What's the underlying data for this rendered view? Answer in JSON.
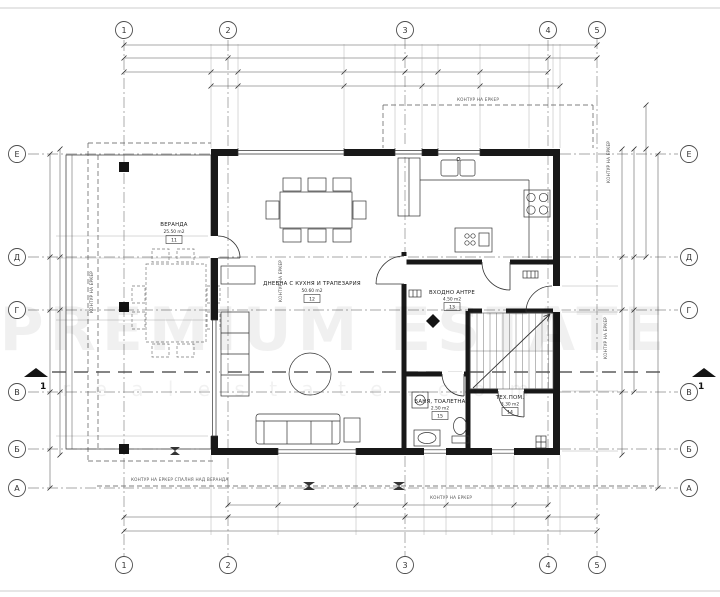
{
  "plan": {
    "grid": {
      "cols": [
        "1",
        "2",
        "3",
        "4",
        "5"
      ],
      "rows": [
        "Е",
        "Д",
        "Г",
        "В",
        "Б",
        "А"
      ]
    },
    "rooms": [
      {
        "name": "ВЕРАНДА",
        "area": "25.50 m2",
        "num": "11"
      },
      {
        "name": "ДНЕВНА С КУХНЯ И ТРАПЕЗАРИЯ",
        "area": "50.60 m2",
        "num": "12"
      },
      {
        "name": "ВХОДНО АНТРЕ",
        "area": "4.50 m2",
        "num": "13"
      },
      {
        "name": "ТЕХ.ПОМ.",
        "area": "3.30 m2",
        "num": "14"
      },
      {
        "name": "БАНЯ, ТОАЛЕТНА",
        "area": "2.50 m2",
        "num": "15"
      }
    ],
    "notes": {
      "bay": "КОНТУР НА ЕРКЕР",
      "bay_bottom": "КОНТУР НА ЕРКЕР СПАЛНЯ НАД ВЕРАНДА",
      "section": "1"
    },
    "watermark": {
      "line1": "PREMIUM ESTATE",
      "line2": "r e a l e s t a t e . c o m"
    },
    "colors": {
      "ink": "#181818",
      "line": "#444444",
      "grid": "#808080",
      "page": "#ffffff"
    }
  }
}
